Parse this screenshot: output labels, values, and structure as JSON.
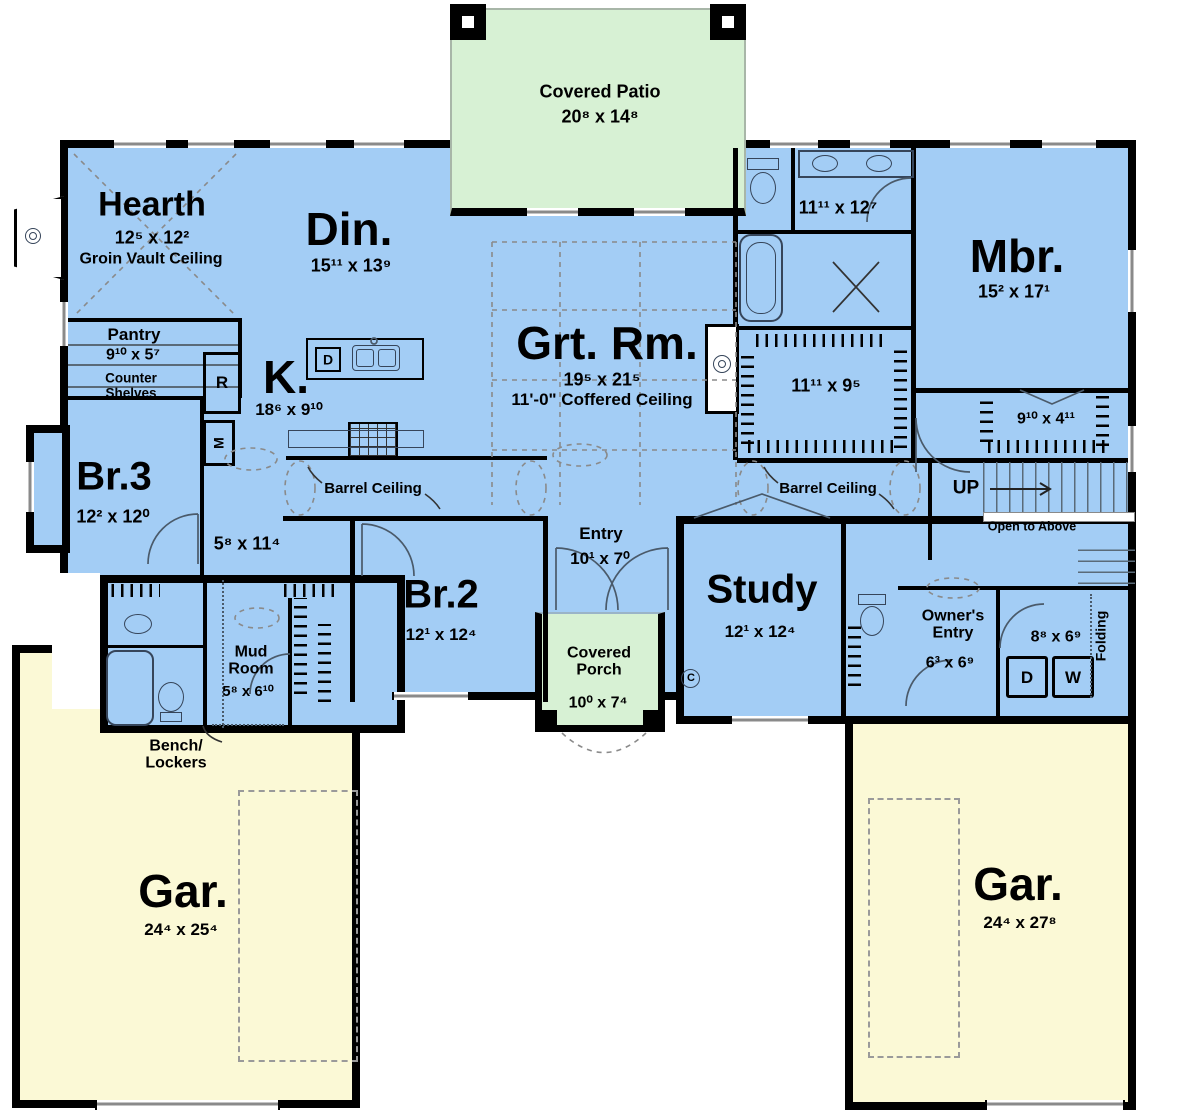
{
  "colors": {
    "room_fill": "#a3cdf5",
    "patio_fill": "#d7f1d4",
    "garage_fill": "#fbf9d6",
    "wall": "#000000"
  },
  "rooms": {
    "covered_patio": {
      "label": "Covered Patio",
      "dims": "20⁸ x 14⁸"
    },
    "hearth": {
      "label": "Hearth",
      "dims": "12⁵ x 12²",
      "note": "Groin Vault Ceiling"
    },
    "dining": {
      "label": "Din.",
      "dims": "15¹¹ x 13⁹"
    },
    "great_room": {
      "label": "Grt. Rm.",
      "dims": "19⁵ x 21⁵",
      "note": "11'-0\" Coffered Ceiling"
    },
    "master_bedroom": {
      "label": "Mbr.",
      "dims": "15² x 17¹"
    },
    "master_bath": {
      "dims": "11¹¹ x 12⁷"
    },
    "master_closet": {
      "dims": "11¹¹ x 9⁵"
    },
    "pantry": {
      "label": "Pantry",
      "dims": "9¹⁰ x 5⁷",
      "note": "Counter Shelves"
    },
    "kitchen": {
      "label": "K.",
      "dims": "18⁶ x 9¹⁰"
    },
    "bedroom3": {
      "label": "Br.3",
      "dims": "12² x 12⁰"
    },
    "hall": {
      "dims": "5⁸ x 11⁴"
    },
    "barrel_left": {
      "label": "Barrel Ceiling"
    },
    "barrel_right": {
      "label": "Barrel Ceiling"
    },
    "bedroom2": {
      "label": "Br.2",
      "dims": "12¹ x 12⁴"
    },
    "entry": {
      "label": "Entry",
      "dims": "10¹ x 7⁰"
    },
    "covered_porch": {
      "label": "Covered Porch",
      "dims": "10⁰ x 7⁴"
    },
    "study": {
      "label": "Study",
      "dims": "12¹ x 12⁴"
    },
    "upper_closet": {
      "dims": "9¹⁰ x 4¹¹"
    },
    "stairs": {
      "up_label": "UP",
      "open_label": "Open to Above"
    },
    "owners_entry": {
      "label": "Owner's Entry",
      "dims": "6³ x 6⁹"
    },
    "laundry": {
      "dims": "8⁸ x 6⁹",
      "note": "Folding"
    },
    "mud_room": {
      "label": "Mud Room",
      "dims": "5⁸ x 6¹⁰"
    },
    "bench_lockers": {
      "label": "Bench/ Lockers"
    },
    "garage_left": {
      "label": "Gar.",
      "dims": "24⁴ x 25⁴"
    },
    "garage_right": {
      "label": "Gar.",
      "dims": "24⁴ x 27⁸"
    }
  },
  "appliances": {
    "refrigerator": "R",
    "microwave": "M",
    "dishwasher": "D",
    "dryer": "D",
    "washer": "W"
  },
  "symbols": {
    "c_marker": "C"
  }
}
